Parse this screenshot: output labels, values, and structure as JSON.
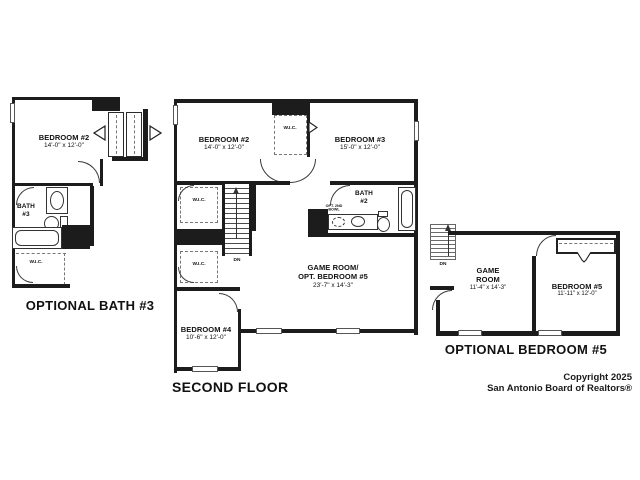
{
  "plans": {
    "left": {
      "title": "OPTIONAL BATH #3",
      "bedroom2_name": "BEDROOM #2",
      "bedroom2_dims": "14'-0\" x 12'-0\"",
      "bath_name_1": "BATH",
      "bath_name_2": "#3",
      "wic": "W.I.C."
    },
    "main": {
      "title": "SECOND FLOOR",
      "bedroom2_name": "BEDROOM #2",
      "bedroom2_dims": "14'-0\" x 12'-0\"",
      "bedroom3_name": "BEDROOM #3",
      "bedroom3_dims": "15'-0\" x 12'-0\"",
      "bedroom4_name": "BEDROOM #4",
      "bedroom4_dims": "10'-6\" x 12'-0\"",
      "gameroom_name_1": "GAME ROOM/",
      "gameroom_name_2": "OPT. BEDROOM #5",
      "gameroom_dims": "23'-7\" x 14'-3\"",
      "bath_name_1": "BATH",
      "bath_name_2": "#2",
      "opt_bowl_1": "OPT. 2ND",
      "opt_bowl_2": "BOWL",
      "wic_closet": "W.I.C.",
      "wic_upper": "W.I.C.",
      "wic_lower": "W.I.C.",
      "dn": "DN"
    },
    "right": {
      "title": "OPTIONAL BEDROOM #5",
      "gameroom_name_1": "GAME",
      "gameroom_name_2": "ROOM",
      "gameroom_dims": "11'-4\" x 14'-3\"",
      "bedroom5_name": "BEDROOM #5",
      "bedroom5_dims": "11'-11\" x 12'-0\"",
      "dn": "DN"
    }
  },
  "copyright": {
    "line1": "Copyright 2025",
    "line2": "San Antonio Board of Realtors®"
  },
  "colors": {
    "wall": "#1c1c1c",
    "background": "#ffffff"
  }
}
